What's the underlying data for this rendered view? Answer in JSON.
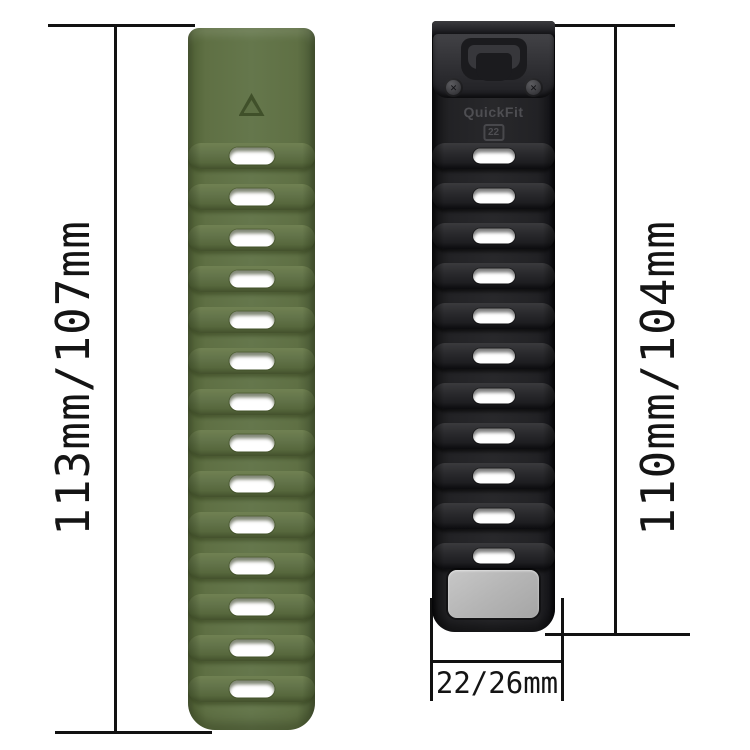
{
  "scene": {
    "background": "#ffffff",
    "line_color": "#111111",
    "description": "Two silicone watch straps with dimension annotations"
  },
  "dimensions": {
    "left": {
      "label": "113mm/107mm"
    },
    "right": {
      "label": "110mm/104mm"
    },
    "bottom": {
      "label": "22/26mm"
    }
  },
  "green_band": {
    "color": "#5e7045",
    "slot_count": 14,
    "marking": "triangle"
  },
  "black_band": {
    "color": "#222225",
    "slot_count": 11,
    "brand_label": "QuickFit",
    "size_label": "22",
    "plate_color": "#b5b5b5"
  }
}
